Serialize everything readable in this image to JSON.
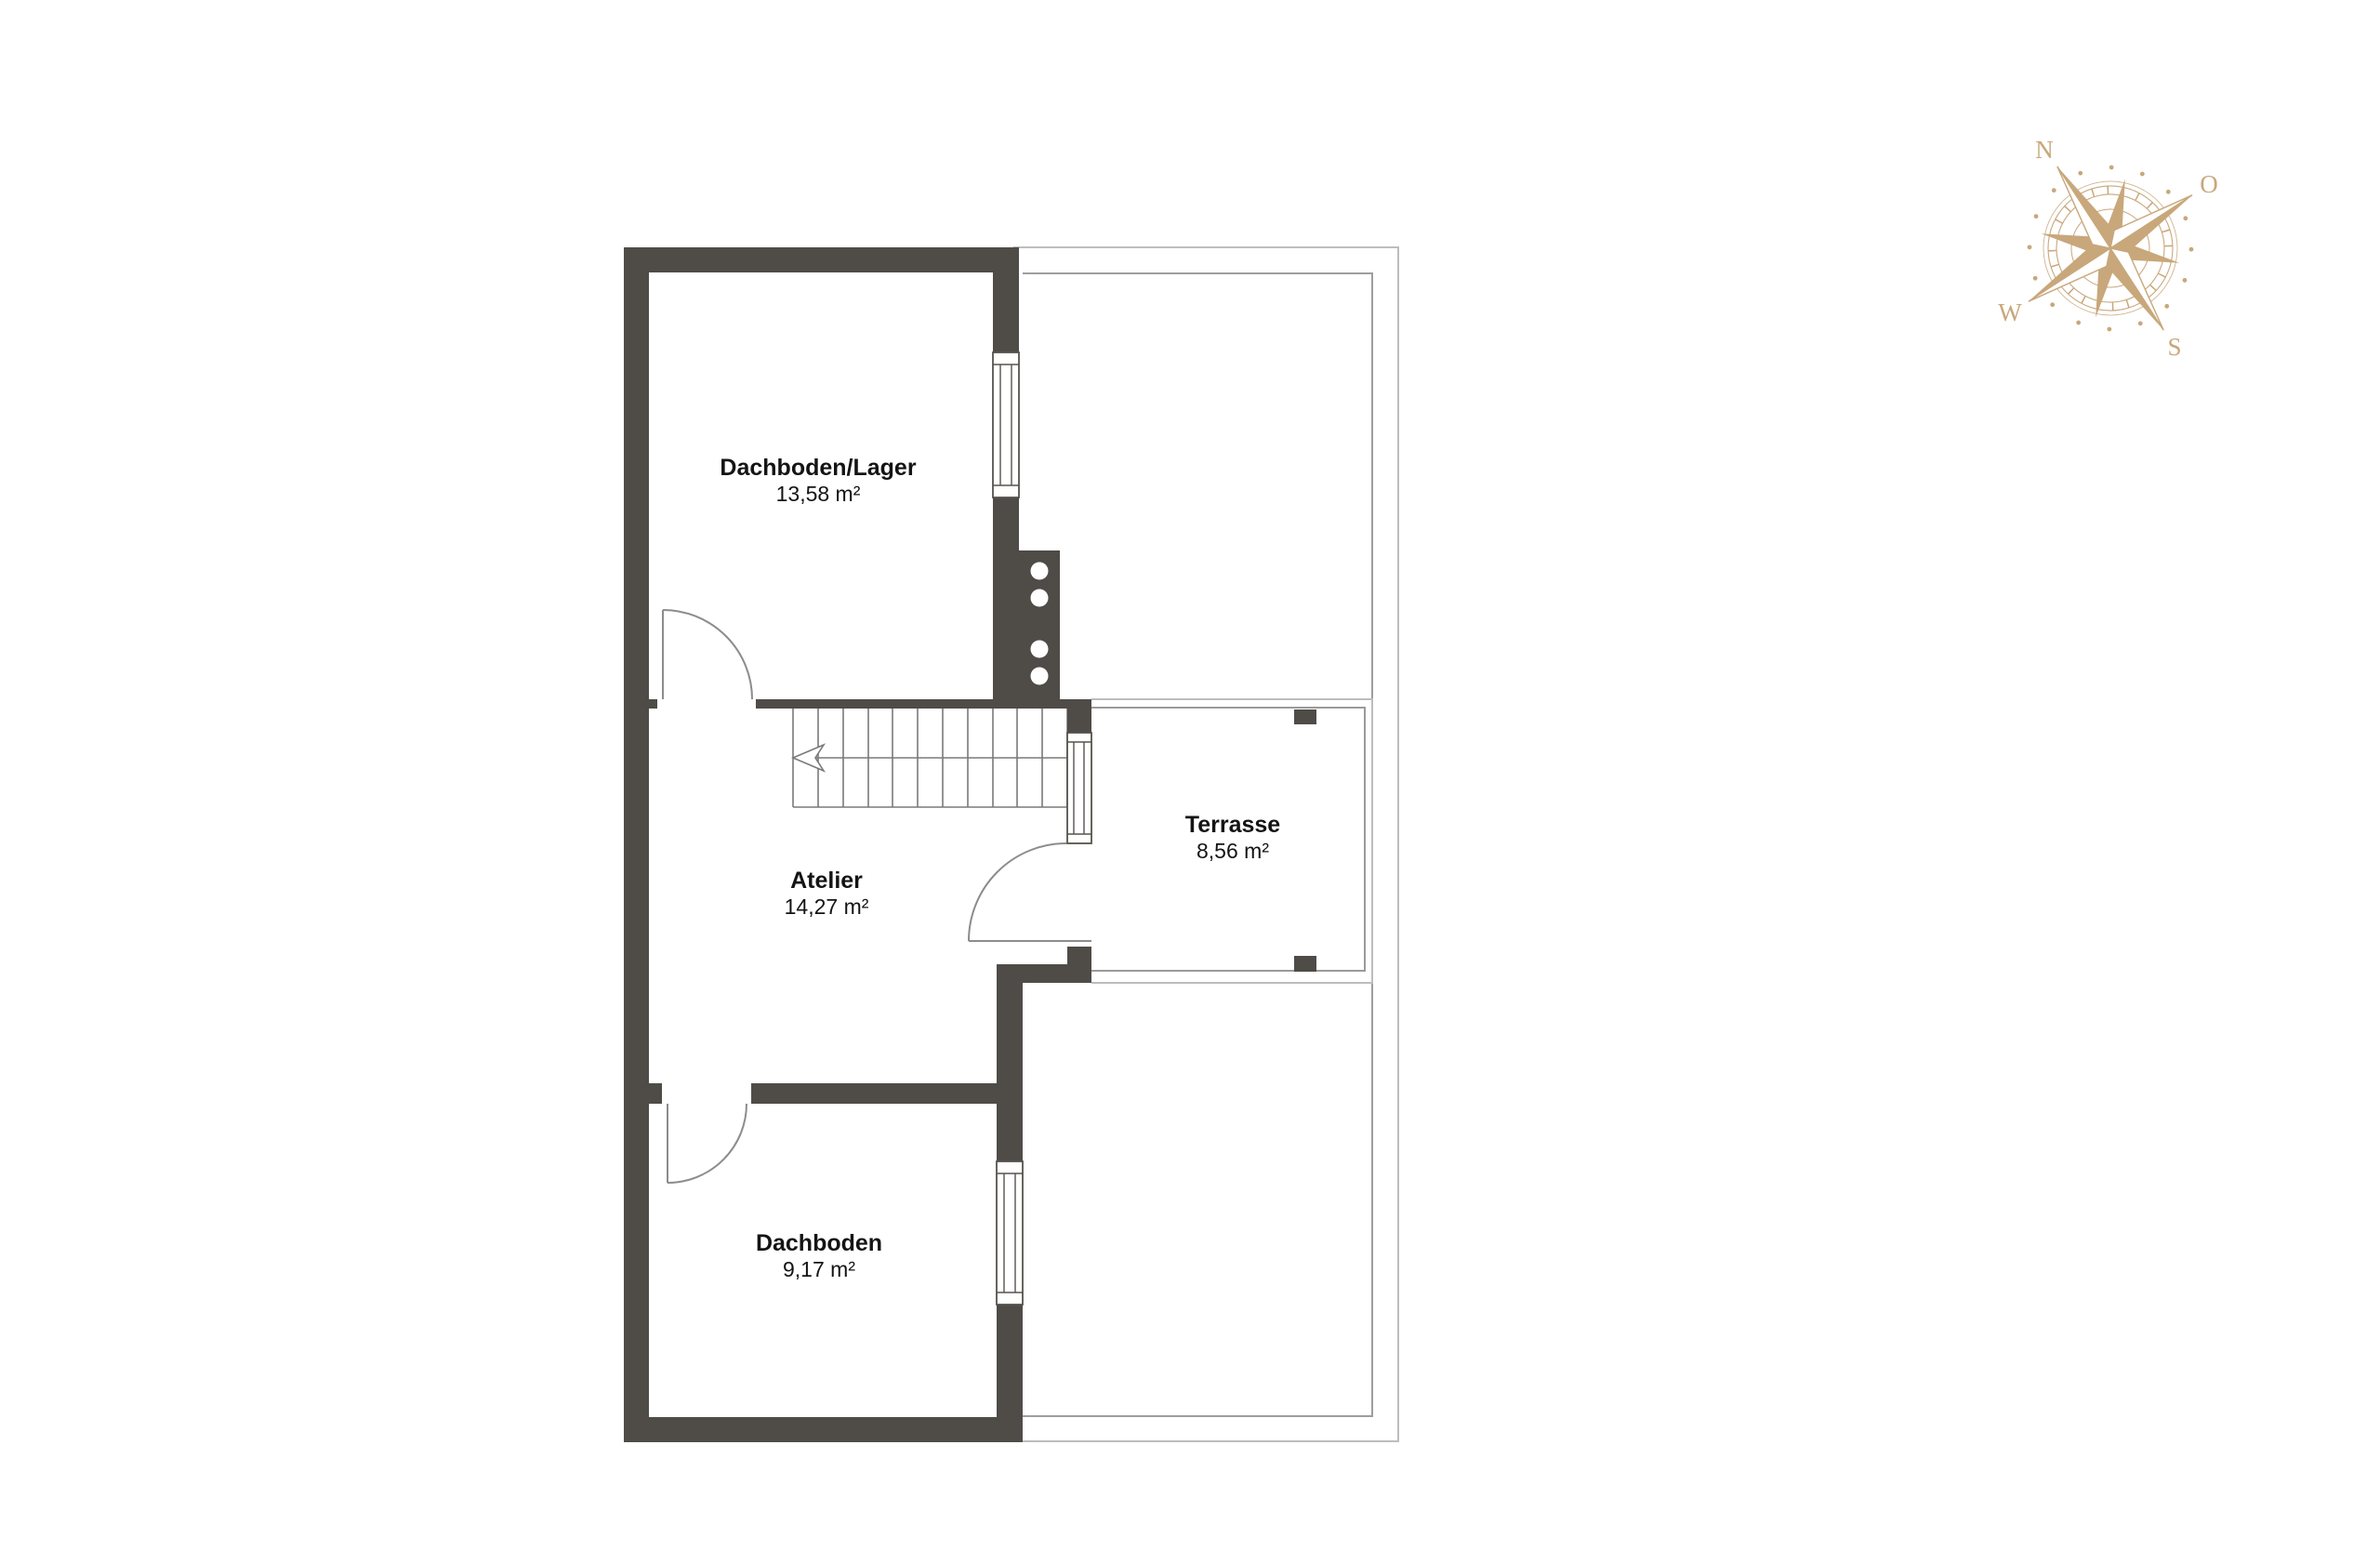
{
  "floor_plan": {
    "rooms": [
      {
        "name": "Dachboden/Lager",
        "area": "13,58 m²"
      },
      {
        "name": "Atelier",
        "area": "14,27 m²"
      },
      {
        "name": "Terrasse",
        "area": "8,56 m²"
      },
      {
        "name": "Dachboden",
        "area": "9,17 m²"
      }
    ]
  },
  "compass": {
    "labels": {
      "north": "N",
      "east": "O",
      "south": "S",
      "west": "W"
    }
  },
  "colors": {
    "background": "#ffffff",
    "wall": "#4f4c48",
    "stair-line": "#7a7a7a",
    "door-line": "#8c8c8c",
    "window-stroke": "#56534f",
    "terrasse-line": "#9a9a9a",
    "roof-outer": "#bdbdbd",
    "roof-inner": "#9e9e9e",
    "text": "#141414",
    "compass": "#c8a77b"
  }
}
